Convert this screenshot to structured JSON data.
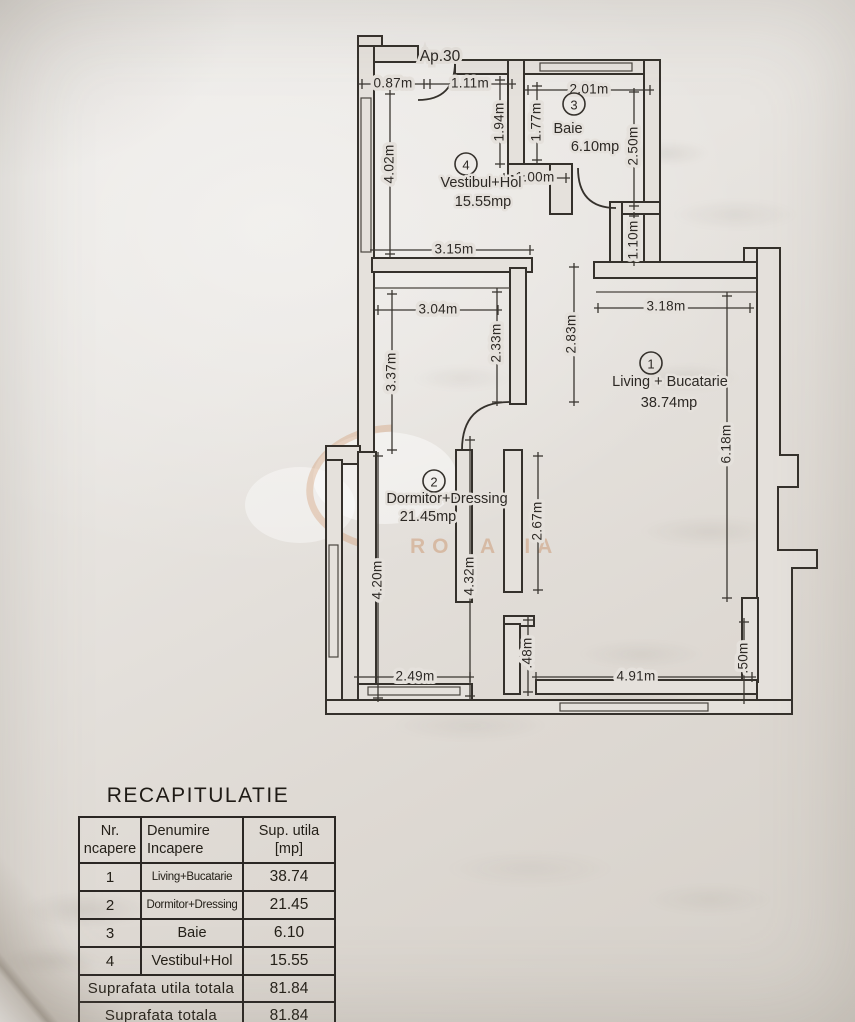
{
  "plan": {
    "apartment_label": "Ap.30",
    "rooms": [
      {
        "num": "1",
        "name": "Living + Bucatarie",
        "area": "38.74mp",
        "circle": [
          651,
          363
        ],
        "name_pos": [
          670,
          382
        ],
        "area_pos": [
          669,
          403
        ]
      },
      {
        "num": "2",
        "name": "Dormitor+Dressing",
        "area": "21.45mp",
        "circle": [
          434,
          481
        ],
        "name_pos": [
          447,
          499
        ],
        "area_pos": [
          428,
          517
        ]
      },
      {
        "num": "3",
        "name": "Baie",
        "area": "6.10mp",
        "circle": [
          574,
          104
        ],
        "name_pos": [
          568,
          129
        ],
        "area_pos": [
          595,
          147
        ]
      },
      {
        "num": "4",
        "name": "Vestibul+Hol",
        "area": "15.55mp",
        "circle": [
          466,
          164
        ],
        "name_pos": [
          481,
          183
        ],
        "area_pos": [
          483,
          202
        ]
      }
    ],
    "dimensions": [
      {
        "label": "0.87m",
        "dir": "h",
        "x1": 362,
        "x2": 424,
        "y": 84,
        "t": [
          393,
          84
        ]
      },
      {
        "label": "1.11m",
        "dir": "h",
        "x1": 430,
        "x2": 512,
        "y": 84,
        "t": [
          470,
          84
        ]
      },
      {
        "label": "2.01m",
        "dir": "h",
        "x1": 528,
        "x2": 650,
        "y": 90,
        "t": [
          589,
          90
        ]
      },
      {
        "label": "1.00m",
        "dir": "h",
        "x1": 504,
        "x2": 566,
        "y": 178,
        "t": [
          535,
          178
        ]
      },
      {
        "label": "3.15m",
        "dir": "h",
        "x1": 374,
        "x2": 530,
        "y": 250,
        "t": [
          454,
          250
        ]
      },
      {
        "label": "3.04m",
        "dir": "h",
        "x1": 378,
        "x2": 498,
        "y": 310,
        "t": [
          438,
          310
        ]
      },
      {
        "label": "3.18m",
        "dir": "h",
        "x1": 598,
        "x2": 750,
        "y": 308,
        "t": [
          666,
          307
        ]
      },
      {
        "label": "2.49m",
        "dir": "h",
        "x1": 358,
        "x2": 470,
        "y": 677,
        "t": [
          415,
          677
        ]
      },
      {
        "label": "4.91m",
        "dir": "h",
        "x1": 536,
        "x2": 752,
        "y": 677,
        "t": [
          636,
          677
        ]
      },
      {
        "label": "4.02m",
        "dir": "v",
        "x": 390,
        "y1": 94,
        "y2": 254,
        "t": [
          390,
          164
        ]
      },
      {
        "label": "1.94m",
        "dir": "v",
        "x": 500,
        "y1": 80,
        "y2": 164,
        "t": [
          500,
          122
        ]
      },
      {
        "label": "1.77m",
        "dir": "v",
        "x": 537,
        "y1": 86,
        "y2": 160,
        "t": [
          537,
          122
        ]
      },
      {
        "label": "2.50m",
        "dir": "v",
        "x": 634,
        "y1": 92,
        "y2": 206,
        "t": [
          634,
          146
        ]
      },
      {
        "label": "1.10m",
        "dir": "v",
        "x": 634,
        "y1": 216,
        "y2": 262,
        "t": [
          634,
          240
        ]
      },
      {
        "label": "2.33m",
        "dir": "v",
        "x": 497,
        "y1": 292,
        "y2": 402,
        "t": [
          497,
          343
        ]
      },
      {
        "label": "2.83m",
        "dir": "v",
        "x": 574,
        "y1": 267,
        "y2": 402,
        "t": [
          572,
          334
        ]
      },
      {
        "label": "3.37m",
        "dir": "v",
        "x": 392,
        "y1": 294,
        "y2": 450,
        "t": [
          392,
          372
        ]
      },
      {
        "label": "6.18m",
        "dir": "v",
        "x": 727,
        "y1": 296,
        "y2": 598,
        "t": [
          727,
          444
        ]
      },
      {
        "label": "4.20m",
        "dir": "v",
        "x": 378,
        "y1": 456,
        "y2": 698,
        "t": [
          378,
          580
        ]
      },
      {
        "label": "4.32m",
        "dir": "v",
        "x": 470,
        "y1": 440,
        "y2": 696,
        "t": [
          470,
          576
        ]
      },
      {
        "label": "2.67m",
        "dir": "v",
        "x": 538,
        "y1": 456,
        "y2": 590,
        "t": [
          538,
          521
        ]
      },
      {
        "label": ".48m",
        "dir": "v",
        "x": 528,
        "y1": 620,
        "y2": 692,
        "t": [
          528,
          653
        ]
      },
      {
        "label": ".50m",
        "dir": "v",
        "x": 744,
        "y1": 622,
        "y2": 700,
        "t": [
          744,
          658
        ]
      }
    ]
  },
  "watermark": {
    "text": "ROMANIA"
  },
  "recap": {
    "title": "RECAPITULATIE",
    "headers": {
      "c1a": "Nr.",
      "c1b": "ncapere",
      "c2a": "Denumire",
      "c2b": "Incapere",
      "c3a": "Sup. utila",
      "c3b": "[mp]"
    },
    "rows": [
      {
        "nr": "1",
        "name": "Living+Bucatarie",
        "value": "38.74"
      },
      {
        "nr": "2",
        "name": "Dormitor+Dressing",
        "value": "21.45"
      },
      {
        "nr": "3",
        "name": "Baie",
        "value": "6.10"
      },
      {
        "nr": "4",
        "name": "Vestibul+Hol",
        "value": "15.55"
      }
    ],
    "totals": [
      {
        "label": "Suprafata utila totala",
        "value": "81.84"
      },
      {
        "label": "Suprafata totala",
        "value": "81.84"
      }
    ],
    "footer": "Executant"
  }
}
